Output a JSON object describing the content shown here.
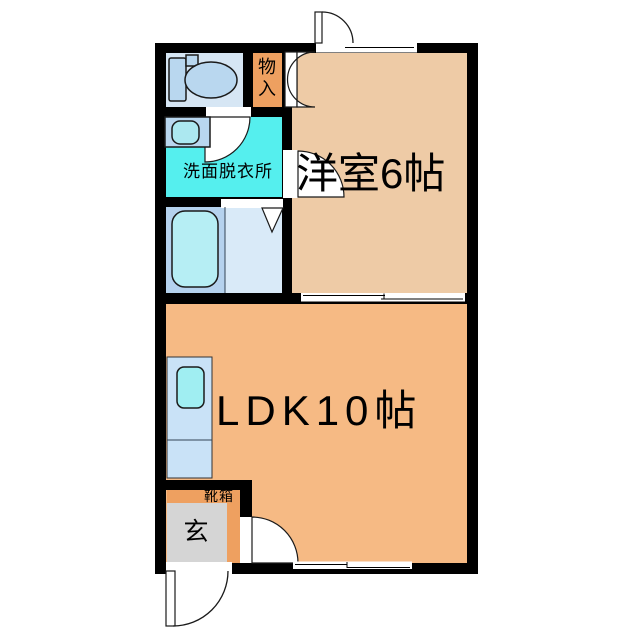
{
  "labels": {
    "western_room": "洋室6帖",
    "ldk": "LDK10帖",
    "washroom": "洗面脱衣所",
    "storage_char_top": "物",
    "storage_char_bottom": "入",
    "entrance": "玄",
    "shoe_box": "靴箱"
  },
  "colors": {
    "wall": "#000000",
    "western_room": "#eecba6",
    "ldk": "#f6ba84",
    "toilet_room": "#d6e6f4",
    "washroom": "#55efee",
    "bath_floor": "#b5d2ee",
    "bathtub": "#b6eef4",
    "bath_entry": "#d9eaf8",
    "kitchen_counter": "#c9e2f7",
    "kitchen_sink": "#a0eef2",
    "fixture": "#b9d7ef",
    "basin": "#ace8f0",
    "storage": "#eea060",
    "entrance_floor": "#d5d5d5",
    "opening": "#ffffff"
  }
}
